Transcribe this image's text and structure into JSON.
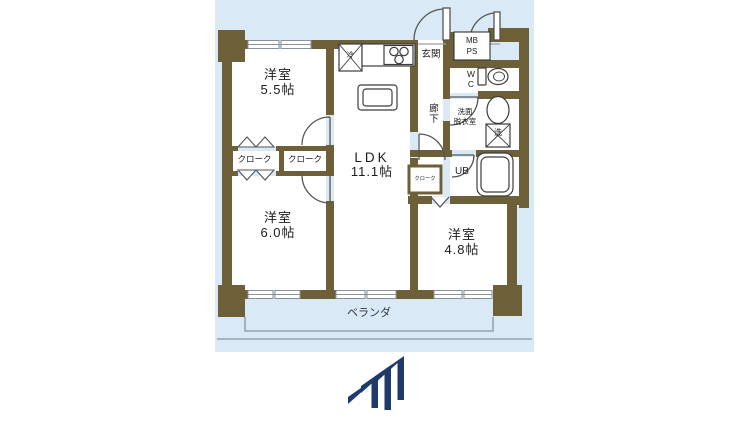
{
  "plan": {
    "bg_color": "#d9eaf6",
    "wall_color": "#6d6038",
    "labels": {
      "bedroom1_name": "洋室",
      "bedroom1_size": "5.5帖",
      "bedroom2_name": "洋室",
      "bedroom2_size": "6.0帖",
      "bedroom3_name": "洋室",
      "bedroom3_size": "4.8帖",
      "ldk_name": "LDK",
      "ldk_size": "11.1帖",
      "entrance": "玄関",
      "corridor": "廊下",
      "mbps_line1": "MB",
      "mbps_line2": "PS",
      "wc": "WC",
      "washroom_line1": "洗面",
      "washroom_line2": "脱衣室",
      "unit_bath": "UB",
      "closet1": "クローク",
      "closet2": "クローク",
      "closet3": "クローク",
      "veranda": "ベランダ",
      "fridge": "冷",
      "washer": "洗"
    }
  },
  "logo": {
    "color": "#1d3a6b"
  }
}
